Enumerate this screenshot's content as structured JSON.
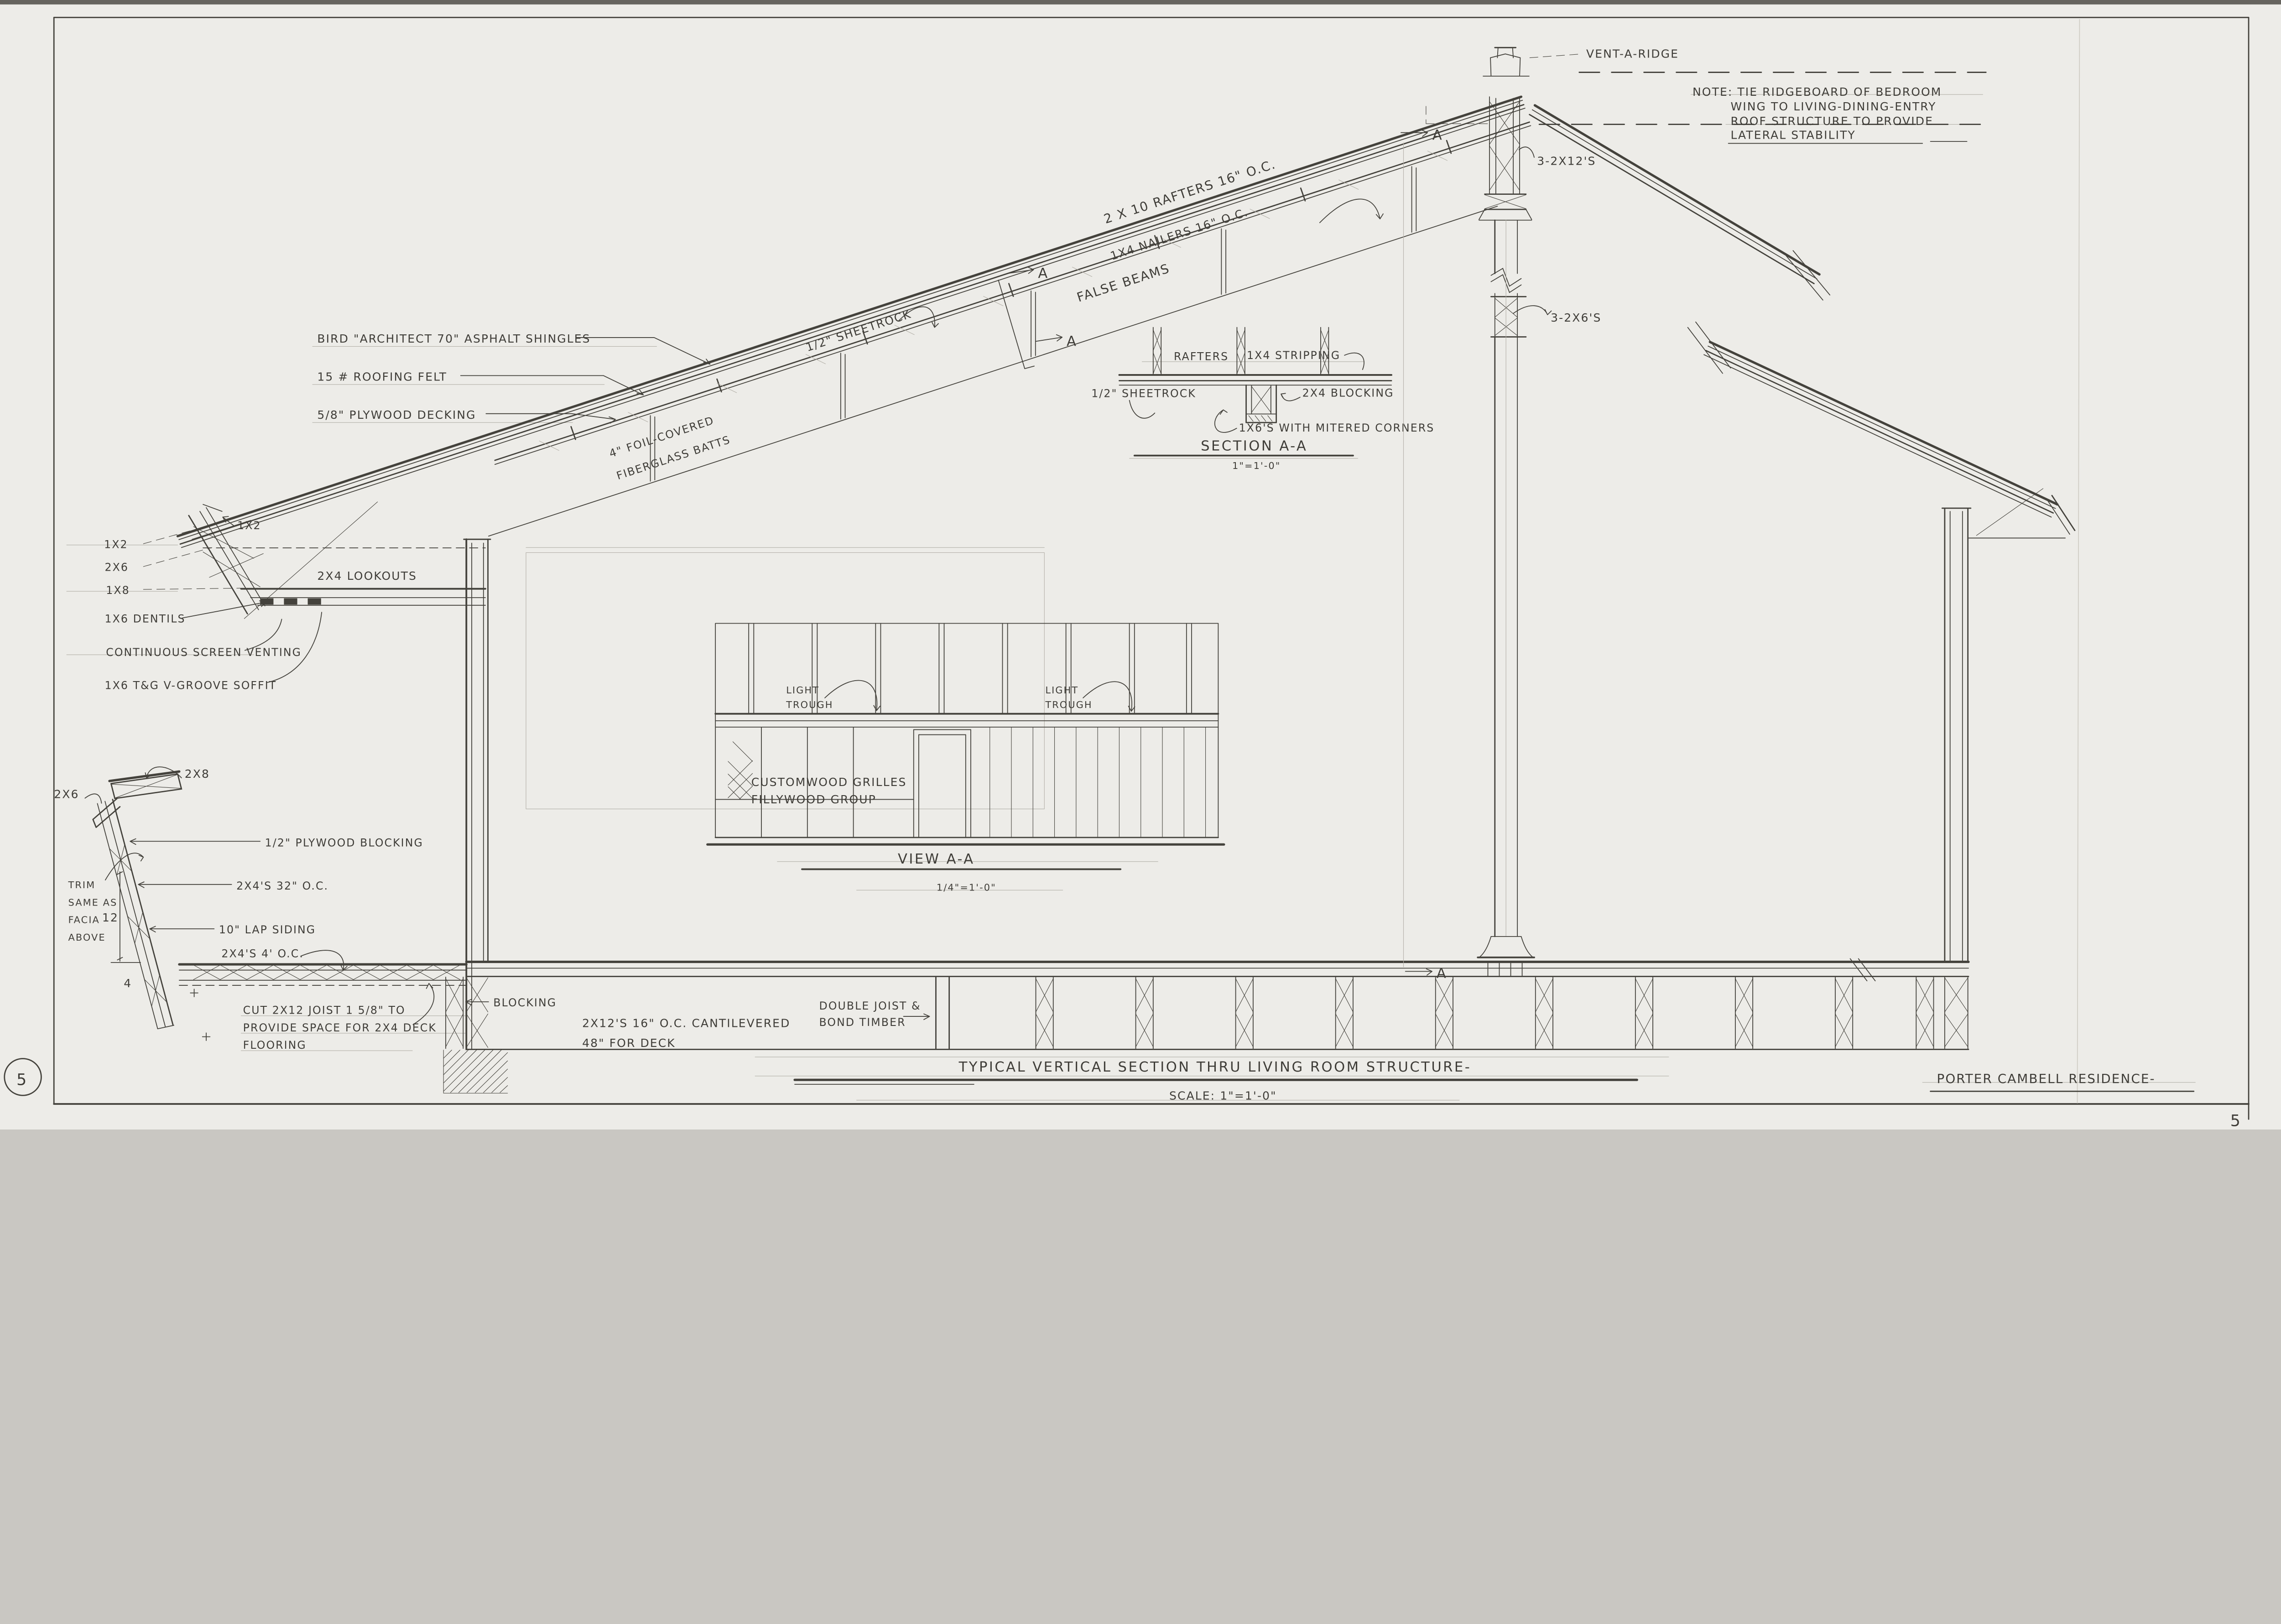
{
  "sheet": {
    "page_number": "5",
    "corner_number": "5",
    "title": "TYPICAL VERTICAL SECTION THRU LIVING ROOM STRUCTURE-",
    "scale": "SCALE: 1\"=1'-0\"",
    "residence": "PORTER CAMBELL RESIDENCE-"
  },
  "ridge_note": {
    "lines": [
      "NOTE: TIE RIDGEBOARD OF BEDROOM",
      "WING TO LIVING-DINING-ENTRY",
      "ROOF STRUCTURE TO PROVIDE",
      "LATERAL STABILITY"
    ]
  },
  "roof": {
    "vent": "VENT-A-RIDGE",
    "ridge_beam": "3-2X12'S",
    "post": "3-2X6'S",
    "rafters": "2 X 10 RAFTERS 16\" O.C.",
    "nailers": "1X4 NAILERS 16\" O.C.",
    "false_beams": "FALSE BEAMS",
    "sheetrock": "1/2\" SHEETROCK",
    "batts": [
      "4\" FOIL-COVERED",
      "FIBERGLASS BATTS"
    ],
    "shingles": "BIRD \"ARCHITECT 70\" ASPHALT SHINGLES",
    "felt": "15 # ROOFING FELT",
    "decking": "5/8\" PLYWOOD DECKING"
  },
  "eave": {
    "fascia_1x2": "1X2",
    "trim_1x2": "1X2",
    "trim_2x6": "2X6",
    "trim_1x8": "1X8",
    "dentils": "1X6 DENTILS",
    "venting": "CONTINUOUS SCREEN VENTING",
    "soffit": "1X6 T&G V-GROOVE SOFFIT",
    "lookouts": "2X4 LOOKOUTS"
  },
  "section_aa": {
    "rafters": "RAFTERS",
    "stripping": "1X4 STRIPPING",
    "sheetrock": "1/2\" SHEETROCK",
    "blocking": "2X4 BLOCKING",
    "mitered": "1X6'S WITH MITERED CORNERS",
    "title": "SECTION A-A",
    "scale": "1\"=1'-0\""
  },
  "view_aa": {
    "light": "LIGHT",
    "trough": "TROUGH",
    "grilles_1": "CUSTOMWOOD GRILLES",
    "grilles_2": "FILLYWOOD GROUP",
    "title": "VIEW A-A",
    "scale": "1/4\"=1'-0\""
  },
  "deck": {
    "cap": "2X8",
    "brace": "2X6",
    "plywood_blocking": "1/2\" PLYWOOD BLOCKING",
    "studs": "2X4'S 32\" O.C.",
    "trim_note": [
      "TRIM",
      "SAME AS",
      "FACIA",
      "ABOVE"
    ],
    "siding": "10\" LAP SIDING",
    "sleepers": "2X4'S 4' O.C.",
    "slope_rise": "12",
    "slope_run": "4",
    "cut_note": [
      "CUT 2X12 JOIST 1 5/8\" TO",
      "PROVIDE SPACE FOR 2X4 DECK",
      "FLOORING"
    ]
  },
  "floor": {
    "blocking": "BLOCKING",
    "joist_note": [
      "2X12'S 16\" O.C. CANTILEVERED",
      "48\" FOR DECK"
    ],
    "double_joist": [
      "DOUBLE JOIST &",
      "BOND TIMBER"
    ]
  },
  "markers": {
    "a": "A"
  }
}
